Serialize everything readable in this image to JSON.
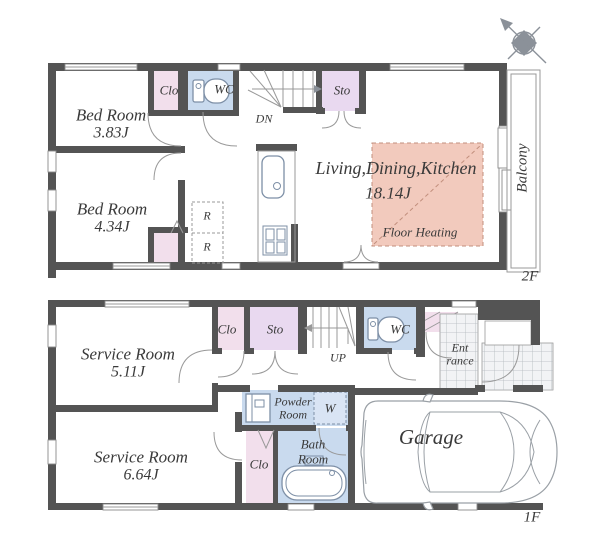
{
  "meta": {
    "floor2_label": "2F",
    "floor1_label": "1F"
  },
  "colors": {
    "wall": "#545454",
    "closet_pink": "#f2dfec",
    "storage_lavender": "#e9d9f0",
    "water_blue": "#c9daee",
    "washer_blue": "#d9e4f4",
    "floor_heating_fill": "#f2cabd",
    "floor_heating_line": "#c28f7d",
    "line_gray": "#999999",
    "fixture_blue_gray": "#7d8fa6",
    "tile_bg": "#f2f3f5",
    "tile_line": "#b3b8bd",
    "text": "#3a3a3a",
    "compass_gray": "#8b9199"
  },
  "floor2": {
    "bedroom1_label": "Bed Room",
    "bedroom1_size": "3.83J",
    "bedroom2_label": "Bed Room",
    "bedroom2_size": "4.34J",
    "clo_top_label": "Clo",
    "wc_label": "WC",
    "stairs_label": "DN",
    "sto_label": "Sto",
    "fridge_r_top": "R",
    "fridge_r_bottom": "R",
    "ldk_label": "Living,Dining,Kitchen",
    "ldk_size": "18.14J",
    "floor_heating_label": "Floor Heating",
    "balcony_label": "Balcony"
  },
  "floor1": {
    "service1_label": "Service Room",
    "service1_size": "5.11J",
    "service2_label": "Service Room",
    "service2_size": "6.64J",
    "clo_top_label": "Clo",
    "sto_label": "Sto",
    "stairs_label": "UP",
    "wc_label": "WC",
    "entrance_line1": "Ent",
    "entrance_line2": "rance",
    "powder_line1": "Powder",
    "powder_line2": "Room",
    "washer_label": "W",
    "clo_side_label": "Clo",
    "bath_line1": "Bath",
    "bath_line2": "Room",
    "garage_label": "Garage"
  }
}
